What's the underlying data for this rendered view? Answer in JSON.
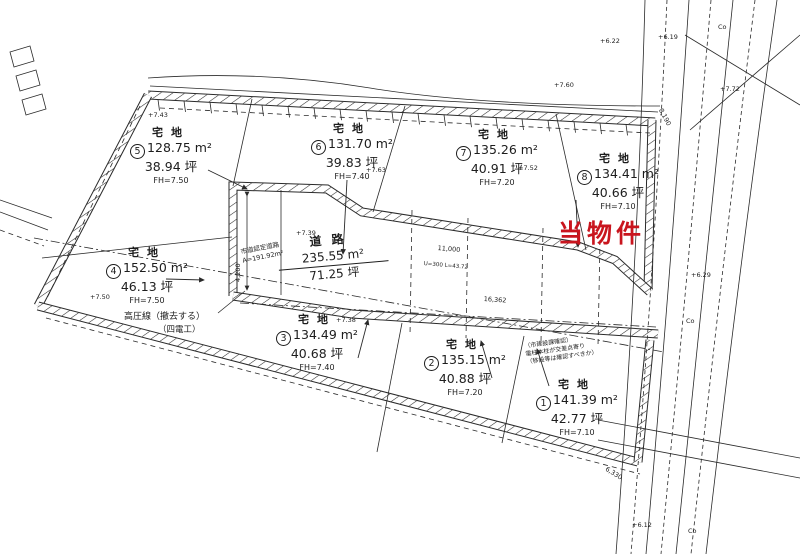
{
  "highlight": {
    "label": "当物件",
    "color": "#c9151e"
  },
  "parcels": [
    {
      "no": "5",
      "type": "宅地",
      "area": "128.75 m²",
      "tsubo": "38.94 坪",
      "fh": "FH=7.50"
    },
    {
      "no": "6",
      "type": "宅地",
      "area": "131.70 m²",
      "tsubo": "39.83 坪",
      "fh": "FH=7.40"
    },
    {
      "no": "7",
      "type": "宅地",
      "area": "135.26 m²",
      "tsubo": "40.91 坪",
      "fh": "FH=7.20"
    },
    {
      "no": "8",
      "type": "宅地",
      "area": "134.41 m²",
      "tsubo": "40.66 坪",
      "fh": "FH=7.10"
    },
    {
      "no": "4",
      "type": "宅地",
      "area": "152.50 m²",
      "tsubo": "46.13 坪",
      "fh": "FH=7.50"
    },
    {
      "no": "3",
      "type": "宅地",
      "area": "134.49 m²",
      "tsubo": "40.68 坪",
      "fh": "FH=7.40"
    },
    {
      "no": "2",
      "type": "宅地",
      "area": "135.15 m²",
      "tsubo": "40.88 坪",
      "fh": "FH=7.20"
    },
    {
      "no": "1",
      "type": "宅地",
      "area": "141.39 m²",
      "tsubo": "42.77 坪",
      "fh": "FH=7.10"
    }
  ],
  "road": {
    "type": "道路",
    "area": "235.55 m²",
    "tsubo": "71.25 坪"
  },
  "annotations": {
    "power_line": "高圧線（撤去する）",
    "power_line_sub": "（四電工）",
    "city_road": "市道認定道路",
    "city_road_area": "A=191.92m²",
    "note_line1": "（市建設課確認）",
    "note_line2": "電柱本柱が交差点寄り",
    "note_line3": "（移設等は確認すべきか）"
  },
  "spots": [
    {
      "label": "+7.43"
    },
    {
      "label": "+7.63"
    },
    {
      "label": "+7.52"
    },
    {
      "label": "+7.39"
    },
    {
      "label": "+7.38"
    },
    {
      "label": "+7.50"
    },
    {
      "label": "+7.60"
    },
    {
      "label": "+6.22"
    },
    {
      "label": "+6.19"
    },
    {
      "label": "+6.29"
    },
    {
      "label": "+6.12"
    },
    {
      "label": "+7.72"
    },
    {
      "label": "Co"
    },
    {
      "label": "Co"
    },
    {
      "label": "Co"
    }
  ],
  "dims": [
    {
      "label": "4,200"
    },
    {
      "label": "11,000"
    },
    {
      "label": "U=300 L=43.72"
    },
    {
      "label": "16,362"
    },
    {
      "label": "8,190"
    },
    {
      "label": "6,330"
    }
  ]
}
